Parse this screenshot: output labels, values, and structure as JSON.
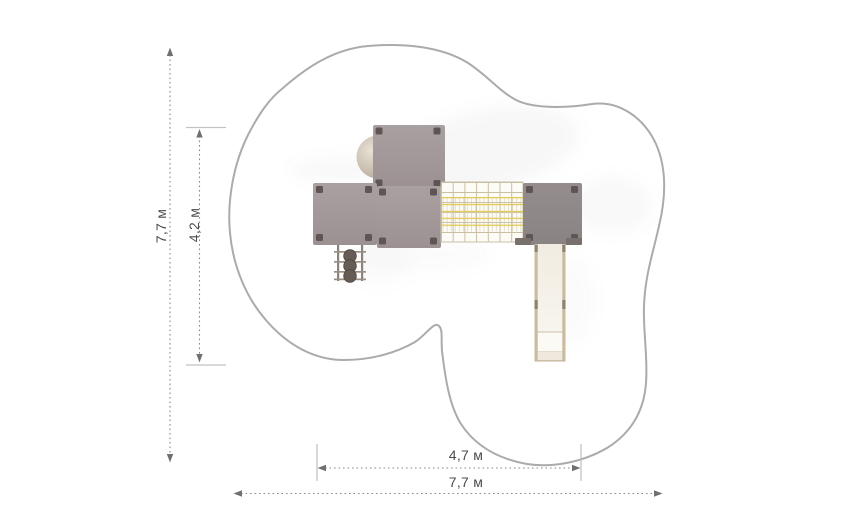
{
  "plan": {
    "type": "playground-equipment-top-view-plan",
    "dimension_labels": {
      "overall_height": "7,7 м",
      "inner_height": "4,2 м",
      "inner_width": "4,7 м",
      "overall_width": "7,7 м"
    }
  },
  "colors": {
    "outline": "#ababab",
    "dimension_line": "#8a8a8a",
    "dimension_text": "#4c4c4c",
    "arrow": "#707070",
    "tick": "#c2c2c2",
    "platform": "#a49a9b",
    "platform_dark": "#8f8888",
    "corner_post": "#5e5554",
    "net_grid": "#c9c0a4",
    "net_rope_yellow": "#e2c84d",
    "slide_rail": "#c9bba0",
    "slide_bed": "#f3eee5",
    "dome": "#cfc5b7",
    "climber_step": "#675c55"
  }
}
